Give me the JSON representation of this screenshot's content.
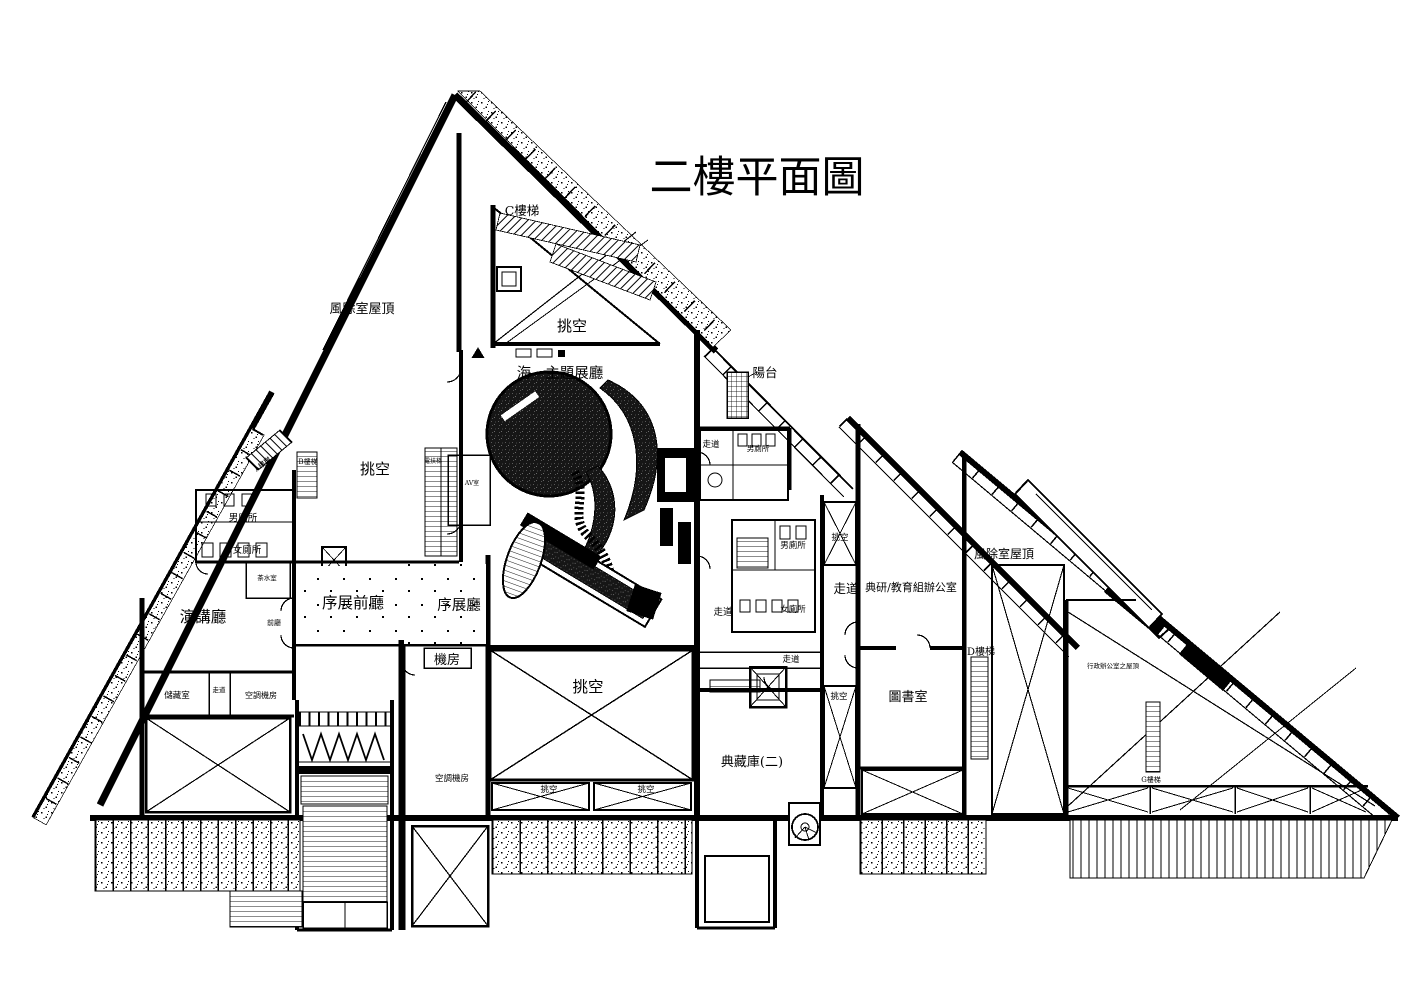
{
  "drawing": {
    "title": "二樓平面圖",
    "style": "black-and-white CAD architectural floor plan",
    "floor": "2F"
  },
  "labels": {
    "title": "二樓平面圖",
    "windbreak_roof_left": "風除室屋頂",
    "c_stairs": "C樓梯",
    "void_upper": "挑空",
    "sea_theme_hall": "海 - 主題展廳",
    "balcony": "陽台",
    "a_stairs": "A樓梯",
    "b_stairs": "B樓梯",
    "void_left": "挑空",
    "escalator": "電扶梯",
    "av_room": "AV室",
    "men_toilet_left": "男廁所",
    "women_toilet_left": "女廁所",
    "tea_room": "茶水室",
    "lecture_hall": "演講廳",
    "front_hall": "前廳",
    "prologue_front_hall": "序展前廳",
    "prologue_hall": "序展廳",
    "machine_room": "機房",
    "storage_room": "儲藏室",
    "corridor_bl": "走道",
    "ac_room_left": "空調機房",
    "ac_room_mid": "空調機房",
    "void_center": "挑空",
    "void_bottom_1": "挑空",
    "void_bottom_2": "挑空",
    "corridor_c_top": "走道",
    "men_toilet_c_top": "男廁所",
    "men_toilet_c": "男廁所",
    "women_toilet_c": "女廁所",
    "corridor_c_mid": "走道",
    "corridor_c_low": "走道",
    "corridor_right": "走道",
    "void_right_upper": "挑空",
    "void_right_lower": "挑空",
    "research_office": "典研/教育組辦公室",
    "windbreak_roof_right": "風除室屋頂",
    "d_stairs": "D樓梯",
    "library": "圖書室",
    "collection_storage_2": "典藏庫(二)",
    "admin_office_roof": "行政辦公室之屋頂",
    "g_stairs": "G樓梯"
  }
}
